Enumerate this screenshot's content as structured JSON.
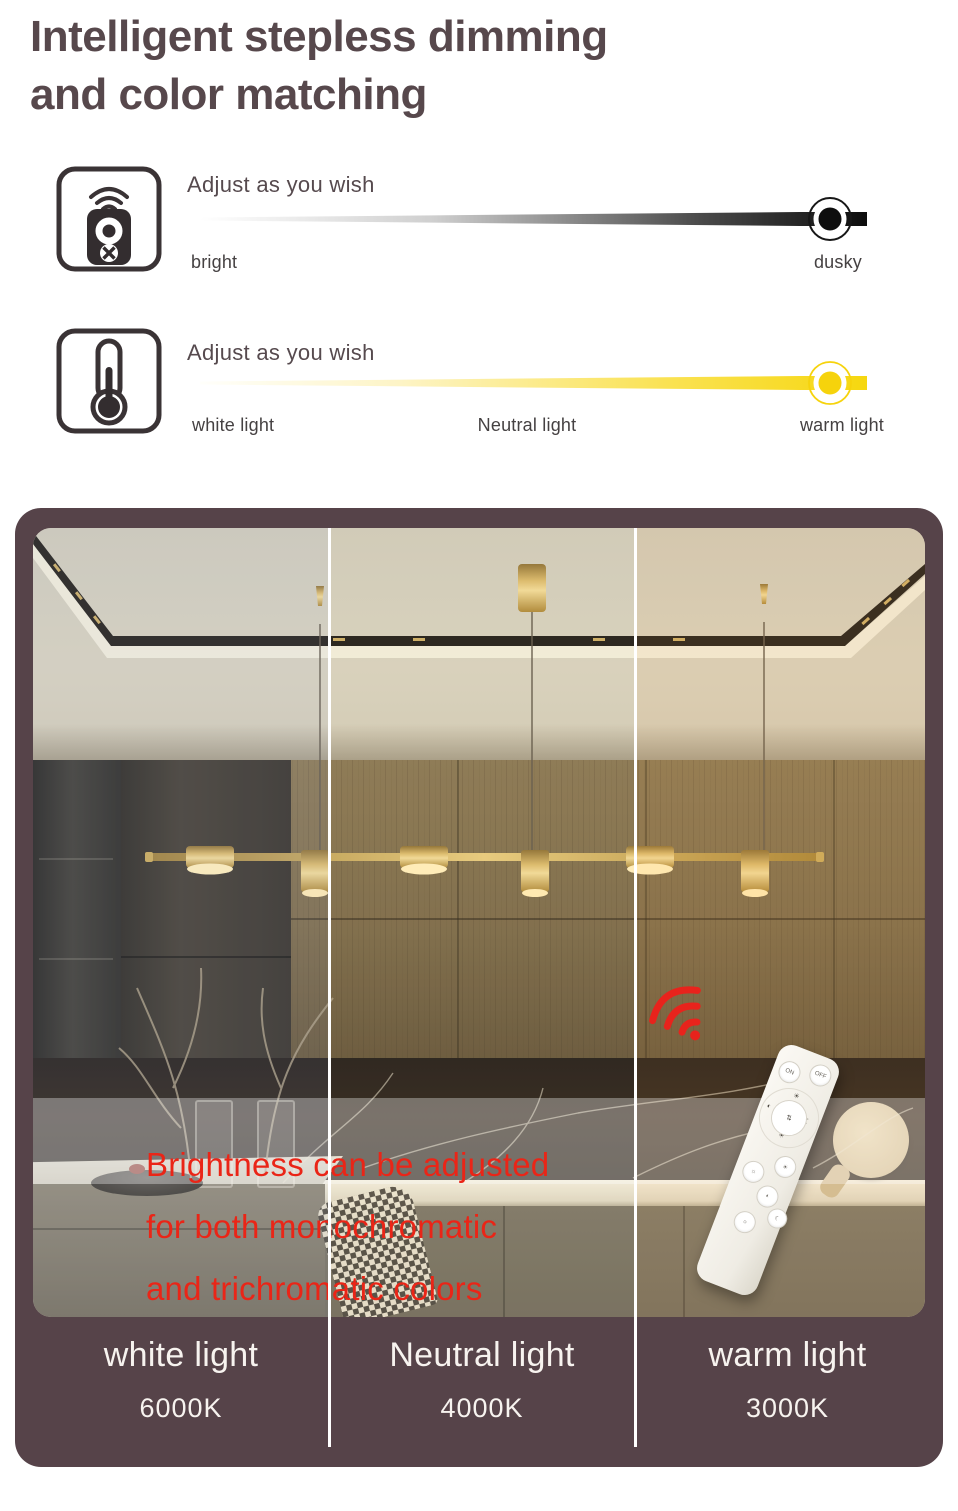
{
  "title": {
    "line1": "Intelligent stepless dimming",
    "line2": "and color matching"
  },
  "sliders": [
    {
      "icon": "remote-control-icon",
      "label": "Adjust as you wish",
      "left_label": "bright",
      "right_label": "dusky",
      "track_start_color": "#ffffff",
      "track_end_color": "#0e0e0e",
      "knob_color": "#0e0e0e"
    },
    {
      "icon": "thermometer-icon",
      "label": "Adjust as you wish",
      "left_label": "white light",
      "mid_label": "Neutral light",
      "right_label": "warm light",
      "track_start_color": "#fffffb",
      "track_end_color": "#f6d70f",
      "knob_color": "#f6d30c"
    }
  ],
  "photo": {
    "overlay_text": {
      "line1": "Brightness can be adjusted",
      "line2": "for both monochromatic",
      "line3": "and trichromatic colors",
      "color": "#ea2517"
    },
    "remote": {
      "on_label": "ON",
      "off_label": "OFF"
    },
    "wifi_icon_color": "#e8231c"
  },
  "panels": [
    {
      "name": "white light",
      "kelvin": "6000K"
    },
    {
      "name": "Neutral light",
      "kelvin": "4000K"
    },
    {
      "name": "warm light",
      "kelvin": "3000K"
    }
  ],
  "colors": {
    "container_brown": "#564349",
    "title_text": "#57484c",
    "accent_red": "#ea2517",
    "accent_yellow": "#f6d30c",
    "tick_text": "#454142",
    "panel_label_text": "#f7f3ef",
    "pendant_gold": "#c9a050"
  }
}
